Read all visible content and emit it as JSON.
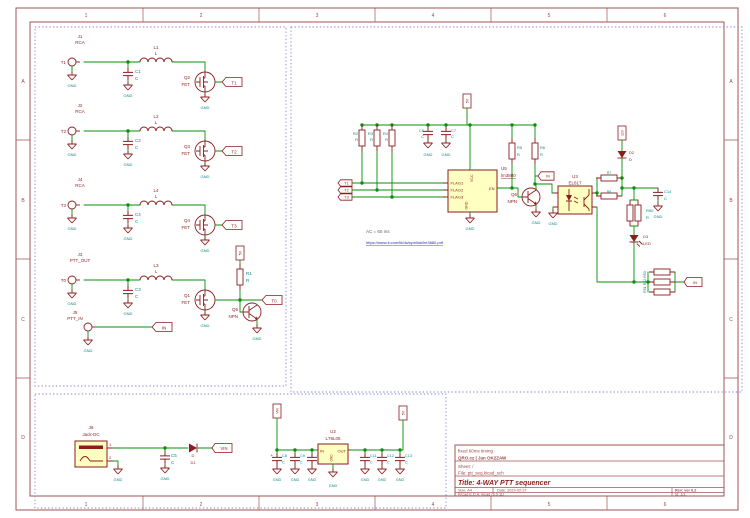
{
  "app": {
    "description": "KiCad schematic sheet - 4-WAY PTT sequencer"
  },
  "colors": {
    "wire_green": "#0a8f0a",
    "symbol_maroon": "#8c1d1d",
    "body_fill_yellow": "#ffffc2",
    "field_teal": "#0d8686",
    "frame_red": "#a25454",
    "link_blue": "#2b2bb5",
    "dashed_box_blue": "#7d7dd6",
    "note_gray": "#5c5c5c"
  },
  "frame": {
    "columns": [
      "1",
      "2",
      "3",
      "4",
      "5",
      "6"
    ],
    "rows": [
      "A",
      "B",
      "C",
      "D"
    ]
  },
  "title_block": {
    "comment_timing": "fixed 60ms timing",
    "comment_author": "QRO.cz   | Jan OK2ZAW",
    "sheet": "Sheet: /",
    "file": "File: ptt_seq.kicad_sch",
    "title": "Title: 4-WAY PTT sequencer",
    "size": "Size: A4",
    "date": "Date: 2023-02-27",
    "rev": "Rev: ver 0.2",
    "tool": "KiCad E.D.A.  kicad (6.0.11)",
    "id": "Id: 1/1"
  },
  "nets": {
    "gnd": "GND",
    "t0": "T0",
    "t1": "T1",
    "t2": "T2",
    "t3": "T3",
    "in": "IN",
    "vin": "VIN",
    "v5": "5V",
    "v12": "12V",
    "plus": "+"
  },
  "stages": [
    {
      "ref": "J1",
      "value": "RCA",
      "input": "T1",
      "cap_ref": "C1",
      "cap_value": "C",
      "ind_ref": "L1",
      "ind_value": "L",
      "fet_ref": "Q2",
      "fet_value": "FET",
      "output": "T1"
    },
    {
      "ref": "J2",
      "value": "RCA",
      "input": "T2",
      "cap_ref": "C2",
      "cap_value": "C",
      "ind_ref": "L2",
      "ind_value": "L",
      "fet_ref": "Q3",
      "fet_value": "FET",
      "output": "T2"
    },
    {
      "ref": "J4",
      "value": "RCA",
      "input": "T3",
      "cap_ref": "C4",
      "cap_value": "C",
      "ind_ref": "L4",
      "ind_value": "L",
      "fet_ref": "Q4",
      "fet_value": "FET",
      "output": "T3"
    },
    {
      "ref": "J3",
      "value": "PTT_OUT",
      "input": "T0",
      "cap_ref": "C3",
      "cap_value": "C",
      "ind_ref": "L3",
      "ind_value": "L",
      "fet_ref": "Q1",
      "fet_value": "FET",
      "output": "T0"
    }
  ],
  "stage4": {
    "r1_ref": "R1",
    "r1_value": "R",
    "q5_ref": "Q5",
    "q5_value": "NPN"
  },
  "ptt_in": {
    "ref": "J5",
    "value": "PTT_IN",
    "output": "IN"
  },
  "main": {
    "r2": "R2",
    "r3": "R3",
    "r4": "R4",
    "r5": "R5",
    "r6": "R6",
    "r7": "R7",
    "r8": "R8",
    "r50": "R50",
    "r_value": "R",
    "c6": "C6",
    "c7": "C7",
    "c14": "C14",
    "c_value": "C",
    "ic_ref": "U5",
    "ic_value": "lm3880",
    "pins": {
      "flag1": "FLAG1",
      "flag2": "FLAG2",
      "flag3": "FLAG3",
      "vcc": "VCC",
      "gnd": "GND",
      "en": "EN"
    },
    "q6_ref": "Q6",
    "q6_value": "NPN",
    "opto_ref": "U3",
    "opto_value": "EL817",
    "d2_ref": "D2",
    "d2_value": "D",
    "d3_ref": "D3",
    "d3_value": "LED",
    "r_cluster": "R51 R52 R53",
    "in_tap": "IN",
    "note": "AC = 60 ms",
    "datasheet": "https://www.ti.com/lit/ds/symlink/lm3880.pdf"
  },
  "power": {
    "j6_ref": "J6",
    "j6_value": "Jack-DC",
    "pin1": "1",
    "pin2": "2",
    "c5_ref": "C5",
    "c_value": "C",
    "d1_ref": "D1",
    "d1_value": "D",
    "reg_ref": "U2",
    "reg_value": "L78L05",
    "reg_pin_in": "IN",
    "reg_pin_out": "OUT",
    "reg_pin_gnd": "GND",
    "cap_refs": [
      "C8",
      "C9",
      "C10",
      "C11",
      "C12",
      "C13"
    ]
  }
}
